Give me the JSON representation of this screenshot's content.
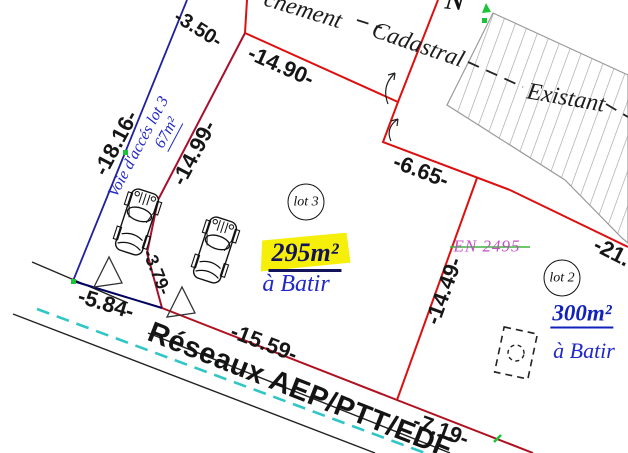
{
  "plan": {
    "north_label": "N",
    "boundary_note": {
      "fragment": "chement",
      "word": "Cadastral"
    },
    "existing_label": "Existant",
    "dimensions": {
      "top": "-3.50-",
      "north": "-14.90-",
      "access_west": "-18.16-",
      "access_east": "-14.99-",
      "notch": "-6.65-",
      "east_offsite": "-21.",
      "east": "-14.49-",
      "access_south": "-3.79-",
      "front_access": "-5.84-",
      "front_lot3": "-15.59-",
      "front_lot2": "-7.19-"
    },
    "access_road": {
      "name": "Voie d'accés lot 3",
      "area": "67m²"
    },
    "lot3": {
      "badge": "lot 3",
      "area": "295m²",
      "status": "à Batir"
    },
    "lot2": {
      "badge": "lot 2",
      "area": "300m²",
      "status": "à Batir"
    },
    "parcel_ref": "EN 2495",
    "networks": "Réseaux AEP/PTT/EDF",
    "colors": {
      "boundary_red": "#dd0f0f",
      "boundary_crimson": "#a8102e",
      "boundary_dark_red": "#b01020",
      "access_blue": "#2020a0",
      "front_navy": "#000060",
      "utility_cyan": "#30c6c6",
      "marker_green": "#19c537",
      "strike_green": "#3db53d",
      "highlight_yellow": "#f6ef0a",
      "label_blue": "#2228c8",
      "ref_magenta": "#c050c0",
      "hatch_gray": "#a3a3a3"
    }
  }
}
